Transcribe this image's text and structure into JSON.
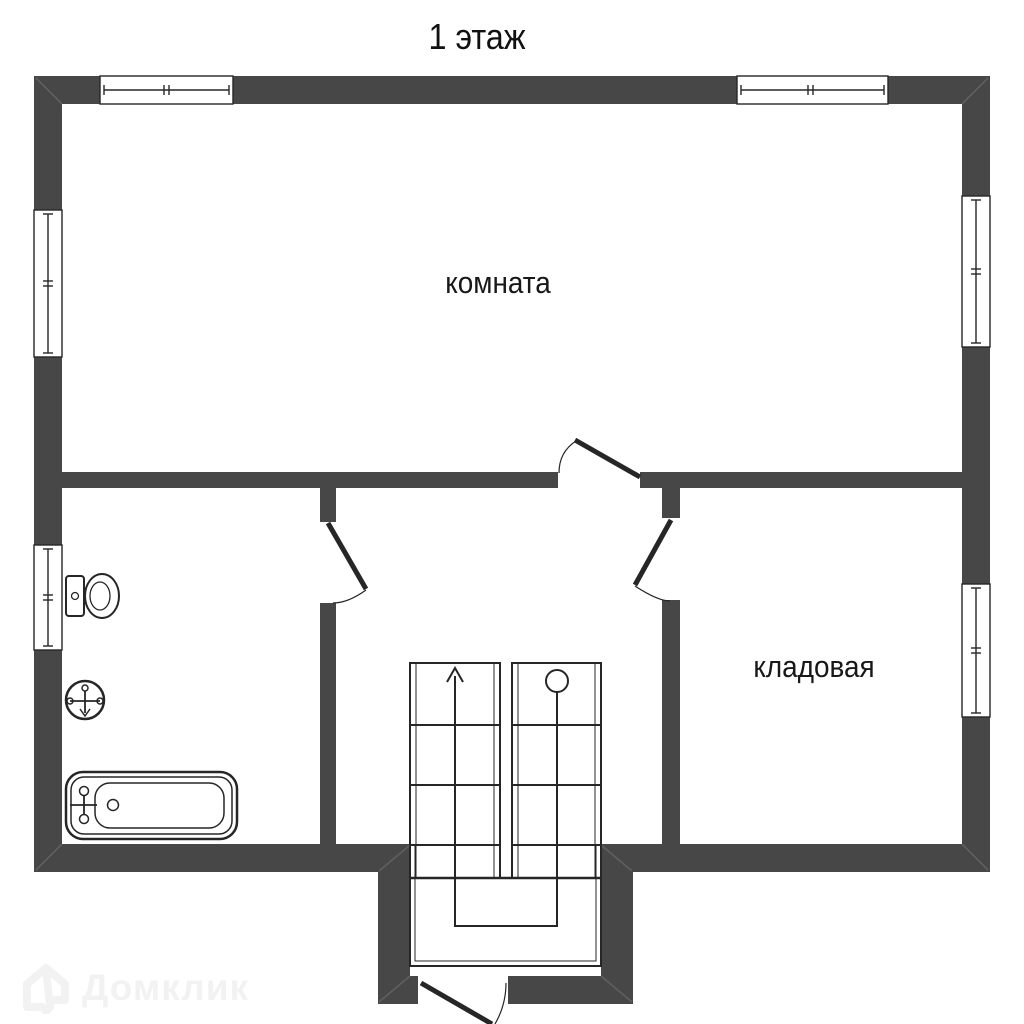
{
  "page": {
    "title": "1 этаж"
  },
  "floor_plan": {
    "wall_color": "#474747",
    "outline_color": "#262626",
    "miter_color": "#5f5f5f",
    "rooms": {
      "living": {
        "label": "комната"
      },
      "storage": {
        "label": "кладовая"
      },
      "bathroom": {
        "label": ""
      }
    },
    "icons": [
      "toilet-icon",
      "sink-icon",
      "bathtub-icon",
      "stairs-up-arrow-icon",
      "stairs-start-circle-icon",
      "door-swing-icon"
    ]
  },
  "watermark": {
    "text": "Домклик",
    "color": "#f2f2f2",
    "icon": "domclick-house-icon"
  }
}
